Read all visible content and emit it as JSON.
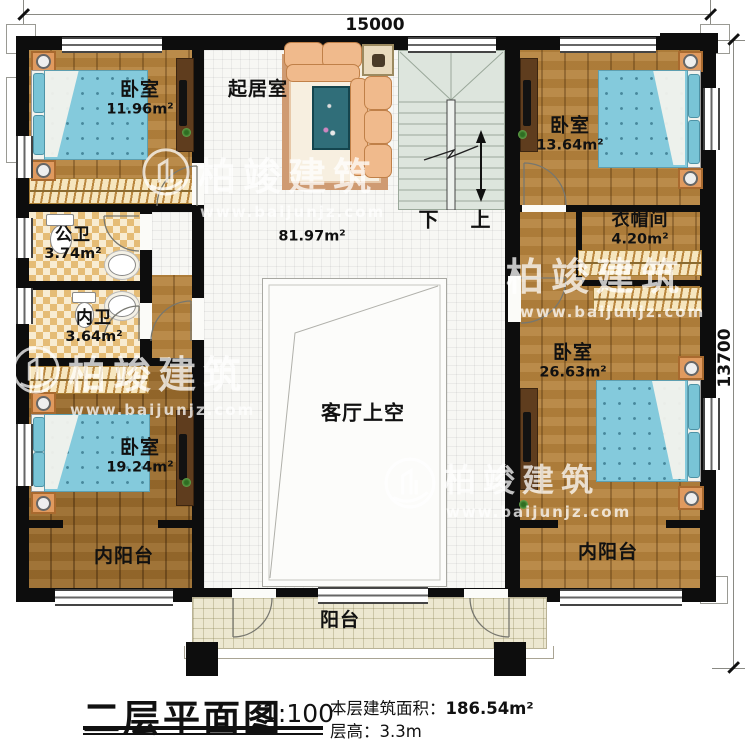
{
  "plan": {
    "dim_top": "15000",
    "dim_right": "13700"
  },
  "rooms": {
    "bedroom_tl": {
      "label": "卧室",
      "area": "11.96m²"
    },
    "living": {
      "label": "起居室",
      "area": "81.97m²"
    },
    "bedroom_tr": {
      "label": "卧室",
      "area": "13.64m²"
    },
    "cloakroom": {
      "label": "衣帽间",
      "area": "4.20m²"
    },
    "public_bath": {
      "label": "公卫",
      "area": "3.74m²"
    },
    "private_bath": {
      "label": "内卫",
      "area": "3.64m²"
    },
    "void": {
      "label": "客厅上空"
    },
    "bedroom_bl": {
      "label": "卧室",
      "area": "19.24m²"
    },
    "bedroom_br": {
      "label": "卧室",
      "area": "26.63m²"
    },
    "inner_balcony_left": {
      "label": "内阳台"
    },
    "inner_balcony_right": {
      "label": "内阳台"
    },
    "balcony": {
      "label": "阳台"
    }
  },
  "stairs": {
    "down": "下",
    "up": "上"
  },
  "title_block": {
    "title": "二层平面图",
    "scale": "1:100",
    "area_label": "本层建筑面积：",
    "area_value": "186.54m²",
    "floor_height_label": "层高：",
    "floor_height_value": "3.3m"
  },
  "watermark": {
    "brand": "柏竣建筑",
    "url": "www.baijunjz.com"
  },
  "colors": {
    "wall": "#0d0d0d",
    "wood": "#b5823c",
    "tile": "#f7f7f4",
    "stair": "#dde5dd",
    "bath_tile": "#e5bc76",
    "balcony_tile": "#ece7d0",
    "bed": "#84cadc",
    "furniture_accent": "#e09a5f"
  }
}
